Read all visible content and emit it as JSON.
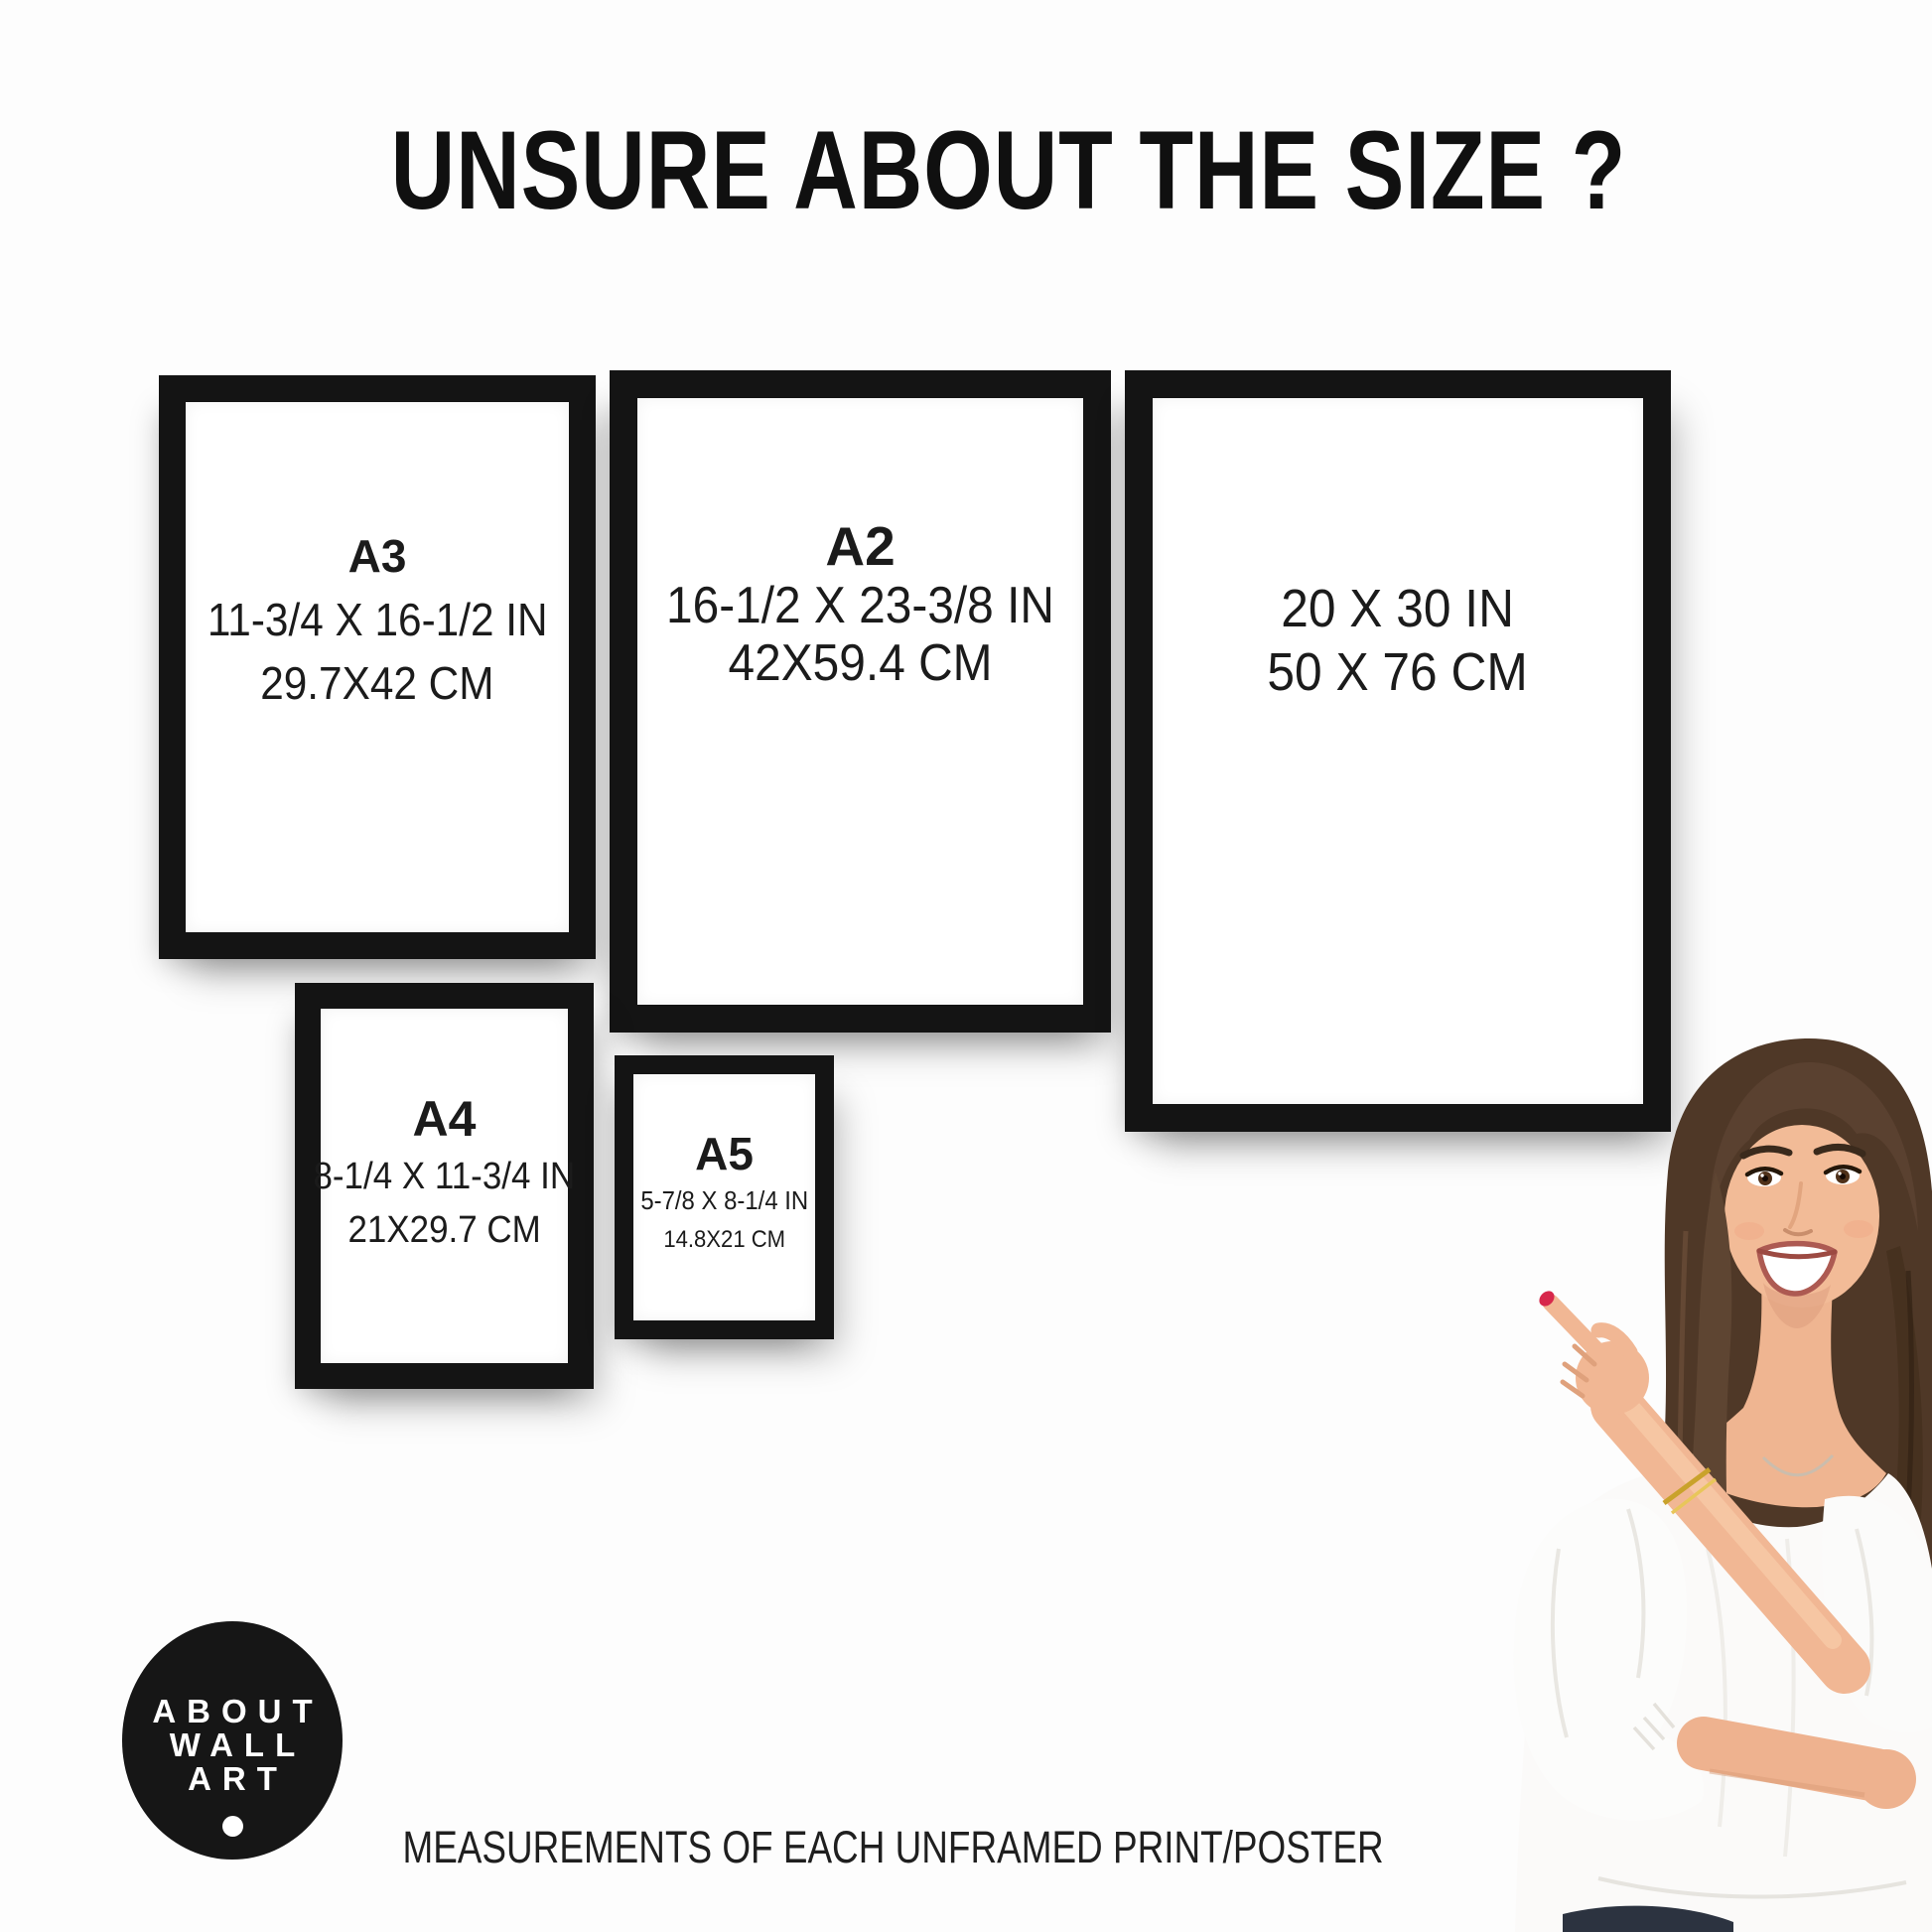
{
  "title": {
    "text": "UNSURE ABOUT THE SIZE ?"
  },
  "frames": [
    {
      "name": "A3",
      "label": "A3",
      "inches": "11-3/4 X 16-1/2 IN",
      "cm": "29.7X42 CM"
    },
    {
      "name": "A2",
      "label": "A2",
      "inches": "16-1/2 X 23-3/8 IN",
      "cm": "42X59.4 CM"
    },
    {
      "name": "20x30",
      "label": "",
      "inches": "20 X 30 IN",
      "cm": "50 X 76 CM"
    },
    {
      "name": "A4",
      "label": "A4",
      "inches": "8-1/4 X 11-3/4 IN",
      "cm": "21X29.7 CM"
    },
    {
      "name": "A5",
      "label": "A5",
      "inches": "5-7/8 X 8-1/4 IN",
      "cm": "14.8X21 CM"
    }
  ],
  "logo": {
    "line1": "ABOUT",
    "line2": "WALL",
    "line3": "ART"
  },
  "caption": {
    "text": "MEASUREMENTS OF EACH UNFRAMED PRINT/POSTER"
  },
  "colors": {
    "frame_border": "#141414",
    "text": "#1b1b1b",
    "logo_background": "#161616",
    "logo_text": "#ffffff",
    "nail_polish": "#d7274b",
    "background": "#fdfdfd"
  }
}
